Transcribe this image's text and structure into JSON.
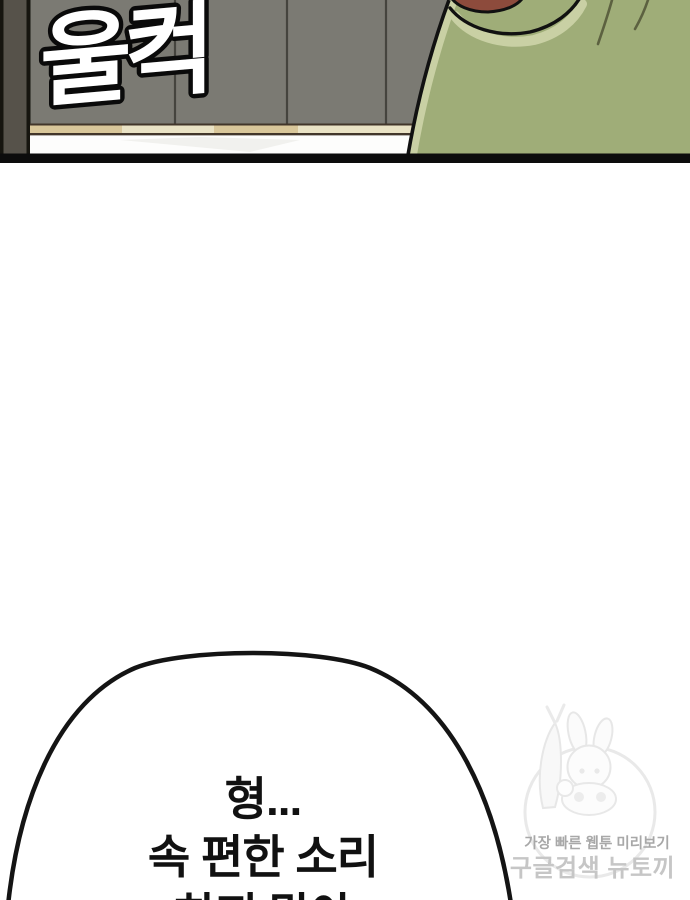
{
  "panel": {
    "sfx_text": "울컥",
    "colors": {
      "wall": "#7b7a73",
      "wall_seam": "#45443e",
      "door_frame": "#56524a",
      "frame_line": "#16150f",
      "baseboard_tan": "#d9c79a",
      "baseboard_cream": "#eae3c5",
      "baseboard_edge": "#42362a",
      "floor": "#fdfdfc",
      "floor_shadow": "#f1f1ee",
      "character_green": "#9fad78",
      "character_green_light": "#c9d0a4",
      "character_skin": "#8d4b3c",
      "outline": "#111111",
      "bottom_bar": "#0c0c0c",
      "sfx_fill": "#ffffff",
      "sfx_outline": "#0a0a0a"
    }
  },
  "speech_bubble": {
    "lines": [
      "형...",
      "속 편한 소리",
      "하지 말아"
    ],
    "fill": "#ffffff",
    "outline": "#141414",
    "text_color": "#111111"
  },
  "watermark": {
    "tagline": "가장 빠른 웹툰 미리보기",
    "brand": "구글검색 뉴토끼",
    "tagline_color": "#a8a8a8",
    "brand_color": "#c6c6c6",
    "line_color": "#e9e9e9",
    "mascot": "bunny-girl-with-carrot"
  }
}
